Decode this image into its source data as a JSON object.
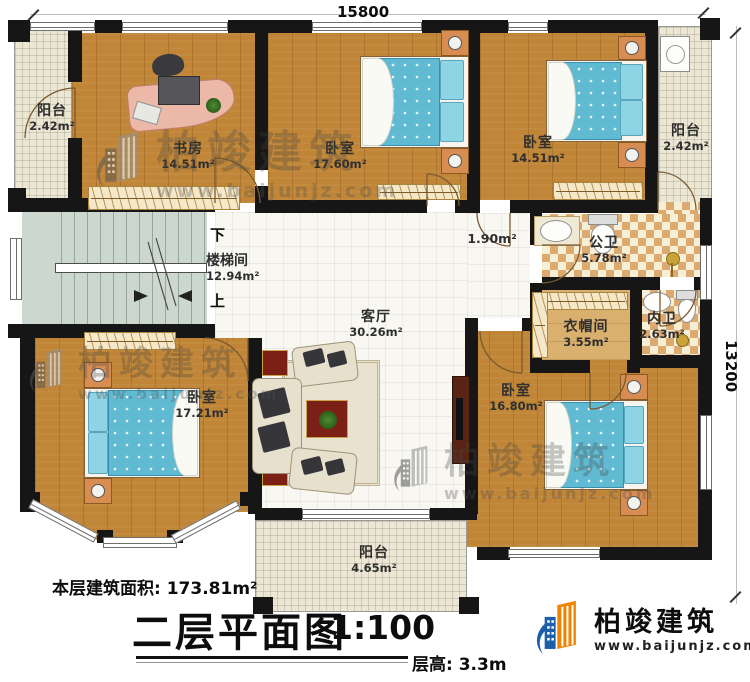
{
  "plan": {
    "dim_top": "15800",
    "dim_right": "13200",
    "stair": {
      "down": "下",
      "up": "上"
    },
    "rooms": {
      "balcony_tl": {
        "name": "阳台",
        "area": "2.42m²"
      },
      "study": {
        "name": "书房",
        "area": "14.51m²"
      },
      "bedroom_top": {
        "name": "卧室",
        "area": "17.60m²"
      },
      "bedroom_tr": {
        "name": "卧室",
        "area": "14.51m²"
      },
      "balcony_tr": {
        "name": "阳台",
        "area": "2.42m²"
      },
      "stairwell": {
        "name": "楼梯间",
        "area": "12.94m²"
      },
      "hall": {
        "name": "",
        "area": "1.90m²"
      },
      "public_bath": {
        "name": "公卫",
        "area": "5.78m²"
      },
      "ensuite_bath": {
        "name": "内卫",
        "area": "2.63m²"
      },
      "cloakroom": {
        "name": "衣帽间",
        "area": "3.55m²"
      },
      "living": {
        "name": "客厅",
        "area": "30.26m²"
      },
      "bedroom_bl": {
        "name": "卧室",
        "area": "17.21m²"
      },
      "bedroom_br": {
        "name": "卧室",
        "area": "16.80m²"
      },
      "balcony_bottom": {
        "name": "阳台",
        "area": "4.65m²"
      }
    }
  },
  "footer": {
    "floor_area": "本层建筑面积: 173.81m²",
    "title": "二层平面图",
    "scale": "1:100",
    "floor_height": "层高: 3.3m"
  },
  "brand": {
    "name": "柏竣建筑",
    "url": "www.baijunjz.com"
  },
  "colors": {
    "wall": "#161616",
    "wood_floor": "#c08536",
    "balcony_tile": "#ebe7d4",
    "living_tile": "#f8f7f2",
    "bath_tile": "#dcaa70",
    "stair": "#ccd8cf",
    "bed_blue": "#5fbad2",
    "logo_blue": "#1c5fa8",
    "logo_orange": "#f08300"
  }
}
